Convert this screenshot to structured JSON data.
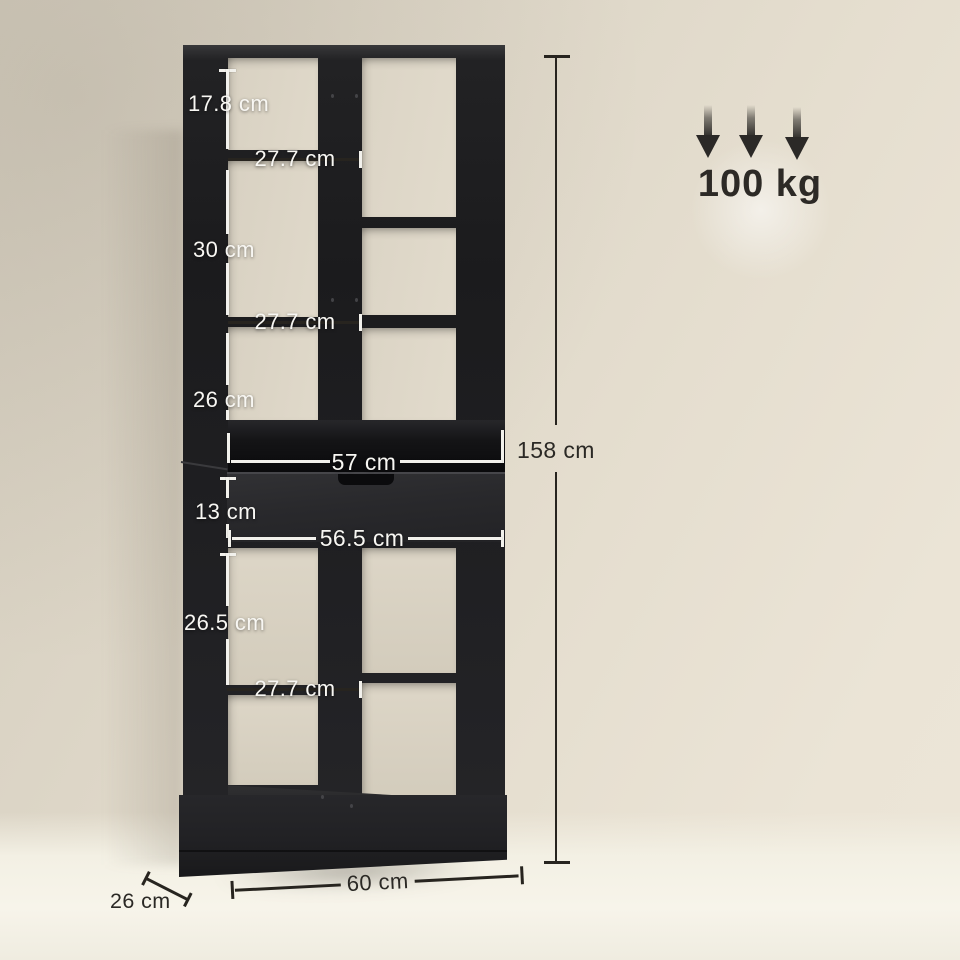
{
  "product": {
    "description": "black bookcase with drawer, dimension diagram"
  },
  "weight": {
    "capacity": "100 kg",
    "icon": "triple-down-arrow-icon"
  },
  "dims": {
    "top_cell_height": "17.8 cm",
    "top_shelf_width": "27.7 cm",
    "middle_cell_height": "30 cm",
    "middle_shelf_width": "27.7 cm",
    "lower_cell_height": "26 cm",
    "open_compartment_width": "57 cm",
    "drawer_height": "13 cm",
    "drawer_width": "56.5 cm",
    "bottom_cell_height": "26.5 cm",
    "bottom_shelf_width": "27.7 cm",
    "overall_height": "158 cm",
    "overall_width": "60 cm",
    "overall_depth": "26 cm"
  },
  "colors": {
    "furniture": "#1d1d1f",
    "drawer_front": "#2a2a2d",
    "wall": "#ddd6c8",
    "floor": "#f5f2e8",
    "dimension_dark": "#27241f",
    "dimension_light": "#f2f1ec"
  }
}
